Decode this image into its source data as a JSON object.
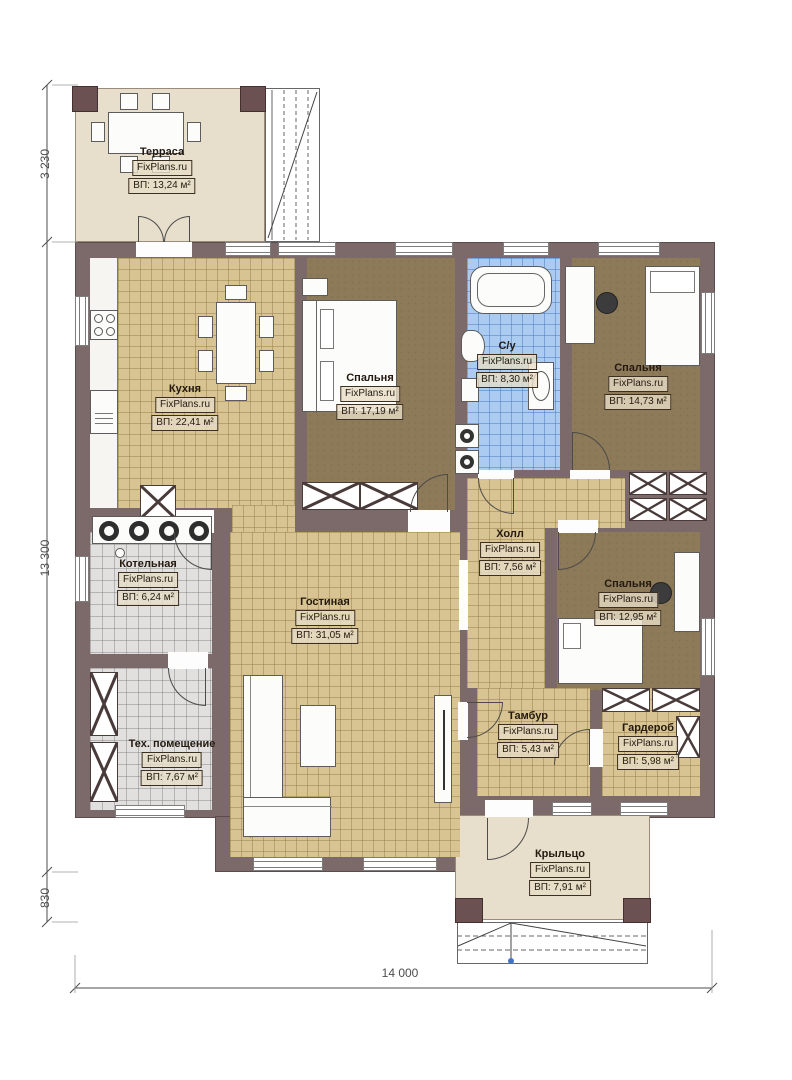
{
  "brand": "FixPlans.ru",
  "rooms": [
    {
      "name": "Терраса",
      "brand": "FixPlans.ru",
      "area": "ВП: 13,24 м²"
    },
    {
      "name": "Кухня",
      "brand": "FixPlans.ru",
      "area": "ВП: 22,41 м²"
    },
    {
      "name": "Спальня",
      "brand": "FixPlans.ru",
      "area": "ВП: 17,19 м²"
    },
    {
      "name": "С/у",
      "brand": "FixPlans.ru",
      "area": "ВП: 8,30 м²"
    },
    {
      "name": "Спальня",
      "brand": "FixPlans.ru",
      "area": "ВП: 14,73 м²"
    },
    {
      "name": "Холл",
      "brand": "FixPlans.ru",
      "area": "ВП: 7,56 м²"
    },
    {
      "name": "Котельная",
      "brand": "FixPlans.ru",
      "area": "ВП: 6,24 м²"
    },
    {
      "name": "Спальня",
      "brand": "FixPlans.ru",
      "area": "ВП: 12,95 м²"
    },
    {
      "name": "Гостиная",
      "brand": "FixPlans.ru",
      "area": "ВП: 31,05 м²"
    },
    {
      "name": "Тех. помещение",
      "brand": "FixPlans.ru",
      "area": "ВП: 7,67 м²"
    },
    {
      "name": "Тамбур",
      "brand": "FixPlans.ru",
      "area": "ВП: 5,43 м²"
    },
    {
      "name": "Гардероб",
      "brand": "FixPlans.ru",
      "area": "ВП: 5,98 м²"
    },
    {
      "name": "Крыльцо",
      "brand": "FixPlans.ru",
      "area": "ВП: 7,91 м²"
    }
  ],
  "dimensions": {
    "terrace_depth": "3 230",
    "house_depth": "13 300",
    "porch_depth": "830",
    "total_width": "14 000"
  },
  "colors": {
    "wall": "#7b6a69",
    "floor_tile_tan": "#d8c392",
    "floor_bedroom": "#8d7a58",
    "floor_bath": "#abccf0",
    "floor_utility": "#e1e0df",
    "floor_outdoor": "#e7decb"
  }
}
